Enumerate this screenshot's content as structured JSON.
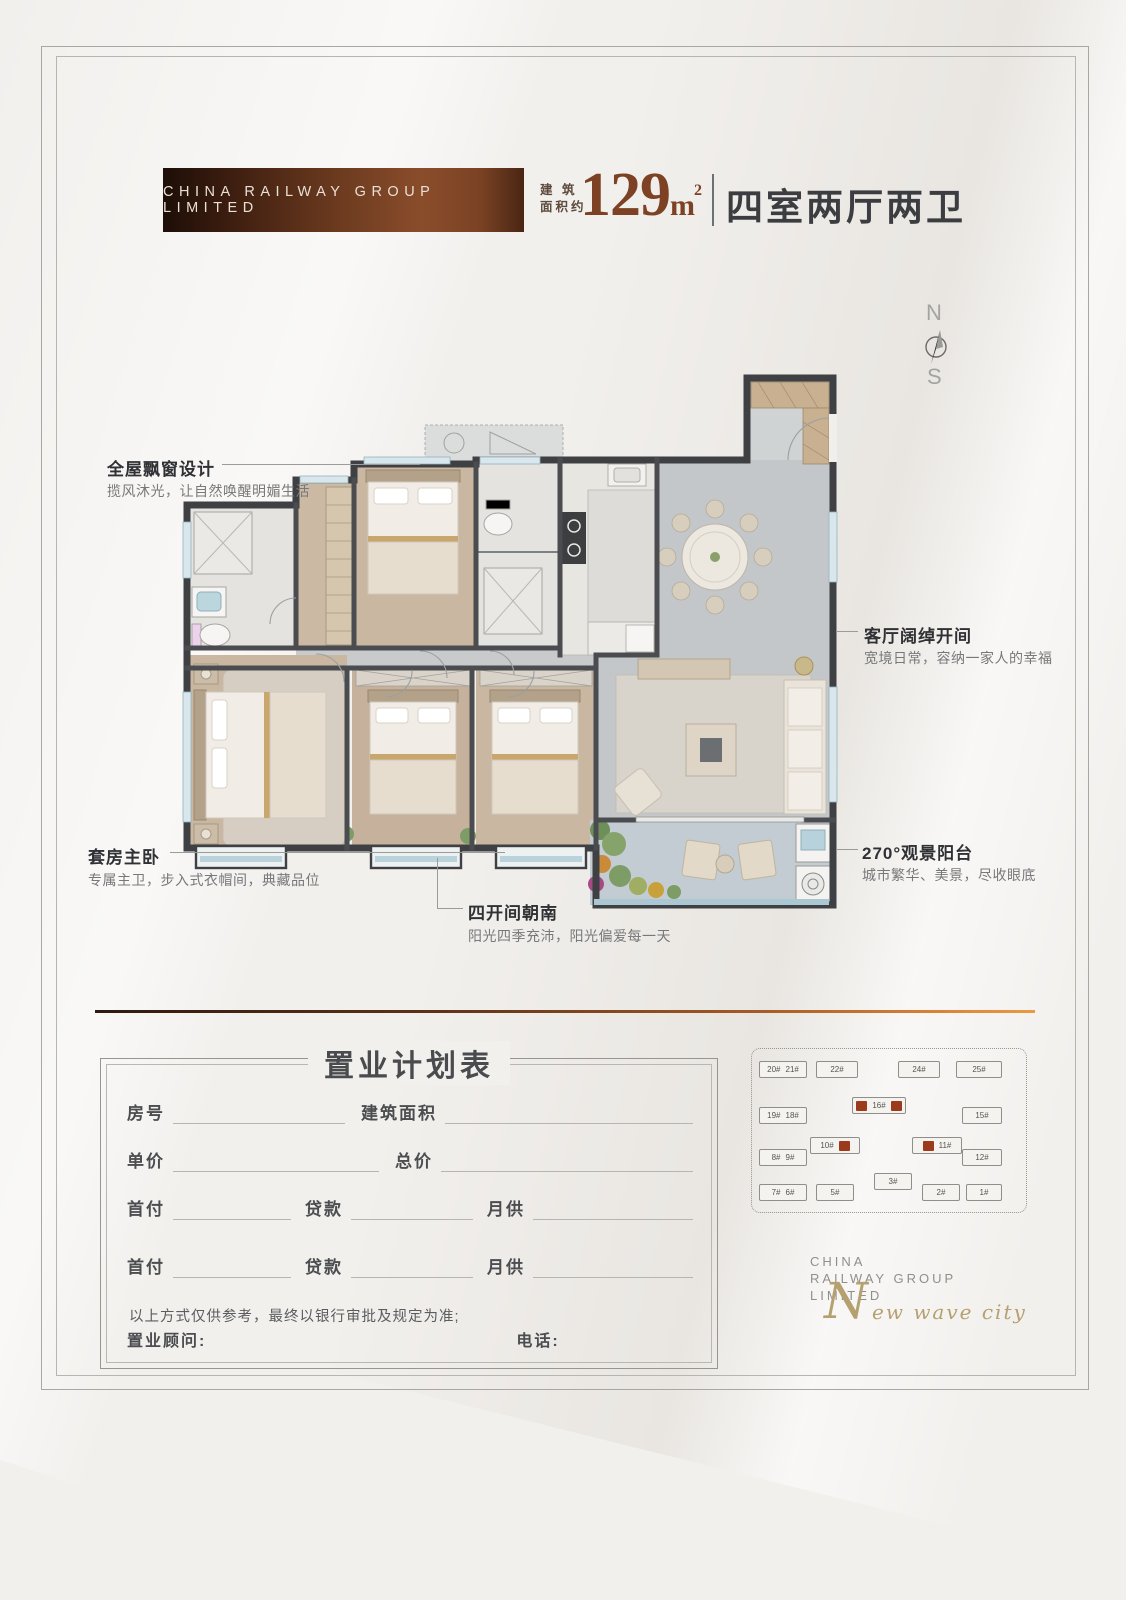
{
  "page": {
    "background": "#f2f0ed"
  },
  "header": {
    "brand_banner": "CHINA RAILWAY GROUP LIMITED",
    "area_label_line1": "建 筑",
    "area_label_line2": "面积约",
    "area_value": "129",
    "area_unit": "m",
    "area_unit_exp": "2",
    "layout_label": "四室两厅两卫"
  },
  "compass": {
    "north": "N",
    "south": "S"
  },
  "callouts": {
    "bay_window": {
      "title": "全屋飘窗设计",
      "desc": "揽风沐光，让自然唤醒明媚生活"
    },
    "living": {
      "title": "客厅阔绰开间",
      "desc": "宽境日常，容纳一家人的幸福"
    },
    "master": {
      "title": "套房主卧",
      "desc": "专属主卫，步入式衣帽间，典藏品位"
    },
    "south_rooms": {
      "title": "四开间朝南",
      "desc": "阳光四季充沛，阳光偏爱每一天"
    },
    "balcony": {
      "title": "270°观景阳台",
      "desc": "城市繁华、美景，尽收眼底"
    }
  },
  "purchase_form": {
    "title": "置业计划表",
    "row1": {
      "c1": "房号",
      "c2": "建筑面积"
    },
    "row2": {
      "c1": "单价",
      "c2": "总价"
    },
    "row3": {
      "c1": "首付",
      "c2": "贷款",
      "c3": "月供"
    },
    "row4": {
      "c1": "首付",
      "c2": "贷款",
      "c3": "月供"
    },
    "disclaimer": "以上方式仅供参考，最终以银行审批及规定为准;",
    "consultant_label": "置业顾问:",
    "phone_label": "电话:"
  },
  "sitemap": {
    "labels": [
      "20#",
      "21#",
      "22#",
      "24#",
      "25#",
      "16#",
      "19#",
      "18#",
      "15#",
      "10#",
      "11#",
      "8#",
      "9#",
      "12#",
      "7#",
      "6#",
      "5#",
      "3#",
      "2#",
      "1#"
    ],
    "highlight_color": "#9e3a1c"
  },
  "footer_logo": {
    "line1": "CHINA",
    "line2": "RAILWAY GROUP",
    "line3": "LIMITED",
    "script_initial": "N",
    "script_rest": "ew wave city"
  },
  "colors": {
    "accent_brown": "#7c4223",
    "wall": "#3e4043",
    "gradient_line_start": "#2e1a10",
    "gradient_line_end": "#e89a44",
    "sitemap_red": "#9e3a1c",
    "gold": "#b5a070"
  }
}
